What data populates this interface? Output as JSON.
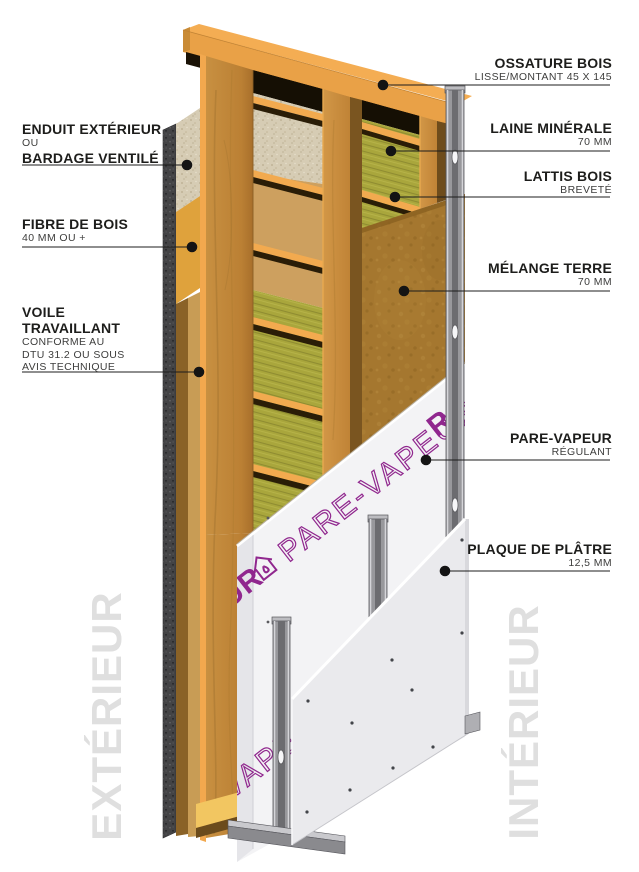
{
  "diagram": {
    "labels_right": [
      {
        "id": "ossature-bois",
        "title": "OSSATURE BOIS",
        "subtitle": "LISSE/MONTANT 45 X 145"
      },
      {
        "id": "laine-minerale",
        "title": "LAINE MINÉRALE",
        "subtitle": "70 MM"
      },
      {
        "id": "lattis-bois",
        "title": "LATTIS BOIS",
        "subtitle": "BREVETÉ"
      },
      {
        "id": "melange-terre",
        "title": "MÉLANGE TERRE",
        "subtitle": "70 MM"
      },
      {
        "id": "pare-vapeur",
        "title": "PARE-VAPEUR",
        "subtitle": "RÉGULANT"
      },
      {
        "id": "plaque-de-platre",
        "title": "PLAQUE DE PLÂTRE",
        "subtitle": "12,5 MM"
      }
    ],
    "labels_left": [
      {
        "id": "enduit-exterieur",
        "line1": "ENDUIT EXTÉRIEUR",
        "line2": "OU",
        "line3": "BARDAGE VENTILÉ"
      },
      {
        "id": "fibre-de-bois",
        "title": "FIBRE DE BOIS",
        "subtitle": "40 MM OU +"
      },
      {
        "id": "voile-travaillant",
        "title1": "VOILE",
        "title2": "TRAVAILLANT",
        "sub1": "CONFORME AU",
        "sub2": "DTU 31.2 OU SOUS",
        "sub3": "AVIS TECHNIQUE"
      }
    ],
    "watermarks": {
      "left": "EXTÉRIEUR",
      "right": "INTÉRIEUR"
    },
    "membrane_print": {
      "partial_left": "EUR",
      "main": "PARE-VAPEUR",
      "partial_bottom": "VAPE",
      "partial_top": "R"
    },
    "colors": {
      "wood_light": "#F3AC52",
      "wood_cap": "#E9A147",
      "wood_stud": "#BE8437",
      "insulation_green": "#A9A63C",
      "earth_brown": "#A5772F",
      "membrane_white": "#F3F3F5",
      "print_purple": "#90278E",
      "plasterboard_grey": "#EAEAED",
      "metal_grey": "#98989C",
      "render_beige": "#D6CCB4",
      "render_dark": "#434345",
      "label_text": "#1D1D1B"
    }
  }
}
